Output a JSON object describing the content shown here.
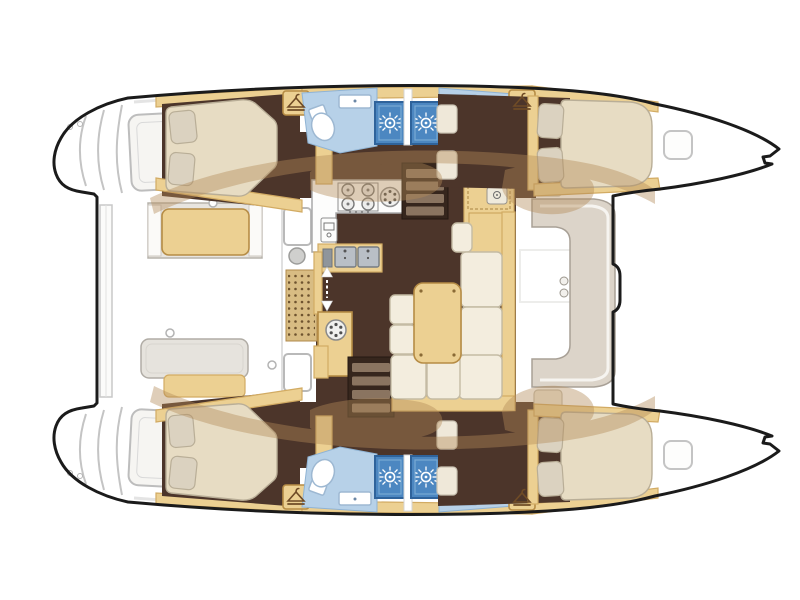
{
  "diagram": {
    "label": "Catamaran deck plan",
    "kind": "yacht floor plan, top-down view",
    "orientation": "bow right, stern left, twin hulls top and bottom",
    "hulls": [
      {
        "name": "hull-top",
        "rooms": [
          {
            "name": "aft-cabin",
            "fixtures": [
              "double-bed",
              "two-pillows",
              "wardrobe-hanger-locker"
            ]
          },
          {
            "name": "aft-head",
            "fixtures": [
              "shower-stall",
              "toilet",
              "washbasin"
            ]
          },
          {
            "name": "forward-head",
            "fixtures": [
              "shower-stall",
              "toilet",
              "washbasin",
              "wardrobe-hanger-locker"
            ]
          },
          {
            "name": "forward-cabin",
            "fixtures": [
              "double-bed",
              "two-pillows",
              "entry-seat-pads",
              "deck-hatch"
            ]
          }
        ]
      },
      {
        "name": "hull-bottom",
        "rooms": [
          {
            "name": "aft-cabin",
            "fixtures": [
              "double-bed",
              "two-pillows",
              "wardrobe-hanger-locker"
            ]
          },
          {
            "name": "aft-head",
            "fixtures": [
              "shower-stall",
              "toilet",
              "washbasin"
            ]
          },
          {
            "name": "forward-head",
            "fixtures": [
              "shower-stall",
              "toilet",
              "washbasin",
              "wardrobe-hanger-locker"
            ]
          },
          {
            "name": "forward-cabin",
            "fixtures": [
              "double-bed",
              "two-pillows",
              "entry-seat-pads",
              "deck-hatch"
            ]
          }
        ]
      }
    ],
    "bridgedeck": {
      "rooms": [
        "aft-cockpit",
        "salon",
        "forward-cockpit-seat"
      ],
      "salon": {
        "galley": [
          "stove-4-burners",
          "round-hob",
          "fridge",
          "double-sink",
          "hatch-locker"
        ],
        "dinette": [
          "u-shaped-sofa",
          "table",
          "two-stools",
          "sideboard-with-sink"
        ],
        "companionways": [
          "stairs-to-top-hull",
          "stairs-to-bottom-hull",
          "entry-arrows",
          "door-mat"
        ]
      },
      "cockpit": [
        "bench-seat-tan",
        "bench-seat-gray",
        "transom-beam",
        "window",
        "round-sink",
        "ring-pulls"
      ]
    },
    "counts": {
      "cabins": 4,
      "heads": 4,
      "showers": 4,
      "toilets": 4,
      "washbasins": 4,
      "wardrobes": 4,
      "stove_burners": 4,
      "galley_sinks": 2,
      "stairs": 2,
      "deck_hatches": 2
    }
  },
  "colors": {
    "deck_white": "#ffffff",
    "hull_outline": "#1b1b1b",
    "line_gray": "#c4c4c4",
    "wood": "#ecd092",
    "wood_edge": "#d2ab63",
    "wood_dark": "#b68c45",
    "floor_dark": "#4c352a",
    "stair_well": "#36261d",
    "stair_tread": "#8a7460",
    "mattress": "#e7dcc3",
    "mattress_edge": "#b9ae97",
    "pillow": "#dbd2c0",
    "pad": "#efe8d9",
    "pad_edge": "#c9c2b2",
    "cushion": "#f3edde",
    "cushion_edge": "#c4bba4",
    "bath_floor": "#b7d1e8",
    "bath_edge": "#8fb3d4",
    "shower": "#4c87c1",
    "shower_edge": "#2f639b",
    "fixture_white": "#ffffff",
    "fixture_edge": "#9db8d2",
    "counter": "#fdfdfc",
    "counter_edge": "#a9a9a9",
    "steel": "#b9bfc6",
    "steel_dark": "#767c82",
    "mat": "#d8bc83",
    "mat_dot": "#6e532f",
    "shadow": "#b28a58",
    "upholstery_gray": "#e6e3dd",
    "hanger_brown": "#6f4b26"
  }
}
